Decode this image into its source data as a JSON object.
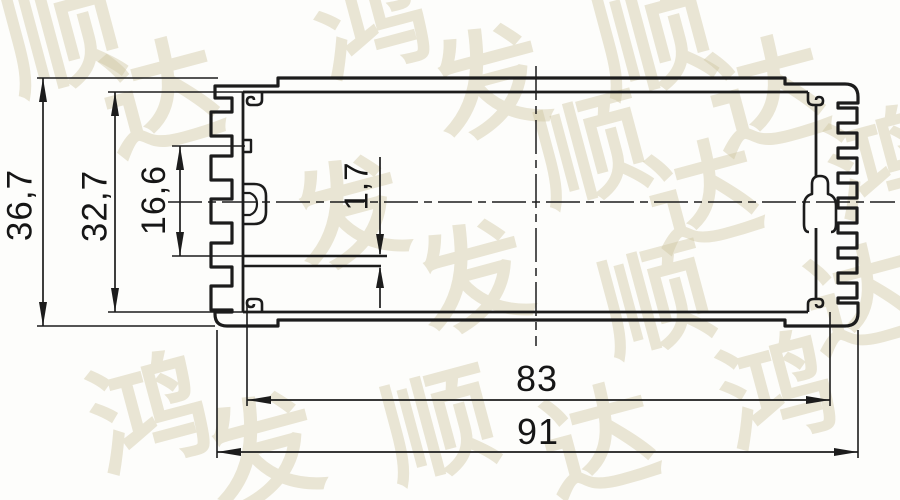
{
  "drawing": {
    "type": "extrusion-cross-section",
    "ink_color": "#1c1c1c",
    "background_color": "#fdfdfb"
  },
  "dimensions": [
    {
      "id": "overall-height",
      "label": "36,7",
      "orientation": "vertical",
      "x": 20,
      "y": 205,
      "rot": -90,
      "size": 35
    },
    {
      "id": "inner-height",
      "label": "32,7",
      "orientation": "vertical",
      "x": 95,
      "y": 206,
      "rot": -90,
      "size": 35
    },
    {
      "id": "rail-offset",
      "label": "16,6",
      "orientation": "vertical",
      "x": 154,
      "y": 200,
      "rot": -90,
      "size": 34
    },
    {
      "id": "slot-width",
      "label": "1,7",
      "orientation": "vertical",
      "x": 356,
      "y": 186,
      "rot": -90,
      "size": 33
    },
    {
      "id": "inner-width",
      "label": "83",
      "orientation": "horizontal",
      "x": 537,
      "y": 379,
      "rot": 0,
      "size": 36
    },
    {
      "id": "overall-width",
      "label": "91",
      "orientation": "horizontal",
      "x": 538,
      "y": 432,
      "rot": 0,
      "size": 36
    }
  ],
  "watermark": {
    "text": "鸿发顺达",
    "color": "rgba(206,195,157,0.42)",
    "tiles": [
      {
        "char": "顺",
        "x": 63,
        "y": 38,
        "size": 118
      },
      {
        "char": "达",
        "x": 162,
        "y": 100,
        "size": 118
      },
      {
        "char": "鸿",
        "x": 372,
        "y": 24,
        "size": 114
      },
      {
        "char": "发",
        "x": 490,
        "y": 86,
        "size": 114
      },
      {
        "char": "顺",
        "x": 654,
        "y": 40,
        "size": 118
      },
      {
        "char": "达",
        "x": 768,
        "y": 98,
        "size": 118
      },
      {
        "char": "鸿",
        "x": 884,
        "y": 166,
        "size": 110
      },
      {
        "char": "发",
        "x": 350,
        "y": 216,
        "size": 112
      },
      {
        "char": "顺",
        "x": 592,
        "y": 152,
        "size": 112
      },
      {
        "char": "达",
        "x": 704,
        "y": 198,
        "size": 112
      },
      {
        "char": "发",
        "x": 474,
        "y": 280,
        "size": 112
      },
      {
        "char": "顺",
        "x": 656,
        "y": 302,
        "size": 112
      },
      {
        "char": "达",
        "x": 862,
        "y": 302,
        "size": 110
      },
      {
        "char": "鸿",
        "x": 150,
        "y": 416,
        "size": 118
      },
      {
        "char": "发",
        "x": 264,
        "y": 454,
        "size": 114
      },
      {
        "char": "顺",
        "x": 440,
        "y": 428,
        "size": 114
      },
      {
        "char": "达",
        "x": 600,
        "y": 444,
        "size": 114
      },
      {
        "char": "鸿",
        "x": 778,
        "y": 394,
        "size": 114
      }
    ]
  }
}
